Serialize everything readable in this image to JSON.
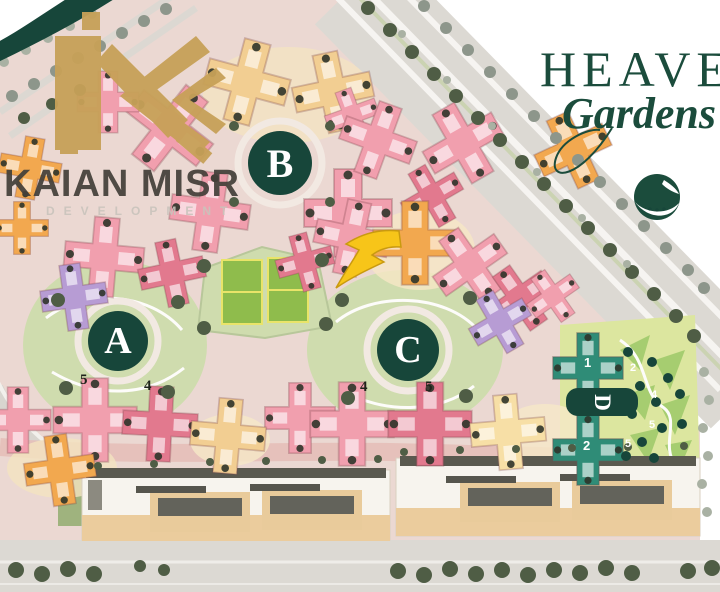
{
  "brand": {
    "wordmark": "KAIAN MISR",
    "subtext": "DEVELOPMENT"
  },
  "project": {
    "title": "HEAVEN",
    "subtitle": "Gardens"
  },
  "zones": [
    {
      "label": "A"
    },
    {
      "label": "B"
    },
    {
      "label": "C"
    },
    {
      "label": "D"
    }
  ],
  "lot_numbers": {
    "row_a": [
      "5",
      "4"
    ],
    "row_c": [
      "4",
      "5"
    ],
    "d_buildings": [
      "1",
      "2"
    ],
    "d_garden": [
      "2",
      "4",
      "5",
      "5"
    ]
  },
  "palette": {
    "sitebase": "#EBD8D2",
    "perimpink": "#E5BFB8",
    "roadgray": "#DCD9D3",
    "roadwhite": "#F6F4F1",
    "parkgreen": "#CFDCAE",
    "court": "#8FBC4C",
    "courtline": "#E9E469",
    "dgarden": "#DCE69F",
    "dfacet": "#A6CD70",
    "pink": "#F19FAE",
    "rose": "#E2798E",
    "tan": "#F2CE92",
    "orange": "#F2A84F",
    "yellow": "#F7DFA6",
    "purple": "#B79CD4",
    "teal": "#2F8C77",
    "treedark": "#4F5D45",
    "treegray": "#8D968B",
    "treelight": "#A9B1A3",
    "zonegreen": "#17463A",
    "gold": "#C7A158",
    "ink": "#44403A",
    "heaven": "#1B4C3C",
    "arrow": "#F7C519",
    "striptan": "#EBCC9D",
    "striproof": "#5A594F",
    "stripbase": "#F7F4EE"
  }
}
